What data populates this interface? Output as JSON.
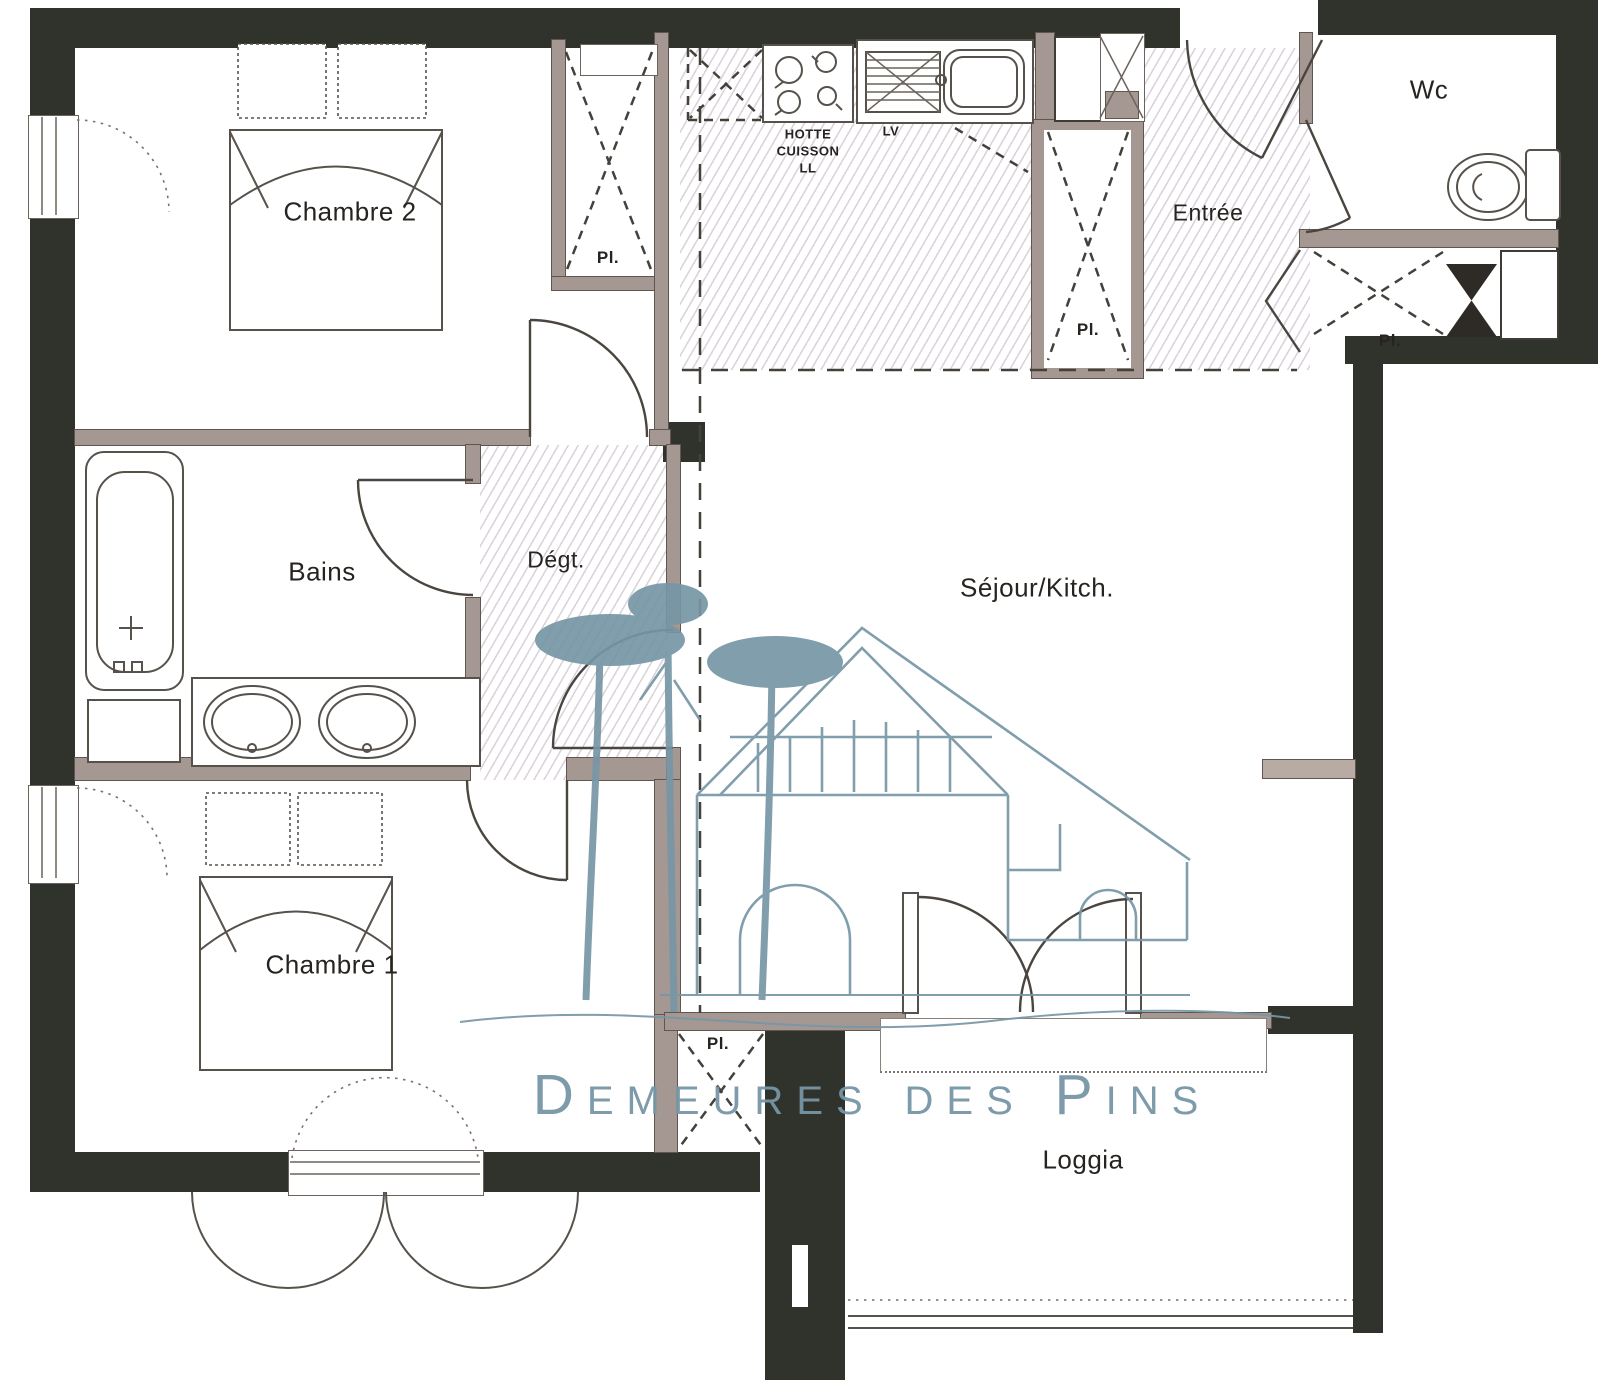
{
  "document": {
    "type": "apartment floor plan"
  },
  "rooms": {
    "chambre2": {
      "label": "Chambre 2"
    },
    "bains": {
      "label": "Bains"
    },
    "degt": {
      "label": "Dégt."
    },
    "chambre1": {
      "label": "Chambre 1"
    },
    "sejour": {
      "label": "Séjour/Kitch."
    },
    "entree": {
      "label": "Entrée"
    },
    "wc": {
      "label": "Wc"
    },
    "loggia": {
      "label": "Loggia"
    }
  },
  "closets": {
    "chambre2": "Pl.",
    "kitchen": "Pl.",
    "wc": "Pl.",
    "chambre1": "Pl."
  },
  "kitchen": {
    "hood_lines": [
      "HOTTE",
      "CUISSON",
      "LL"
    ],
    "dishwasher_label": "LV"
  },
  "watermark": {
    "text": "Demeures des Pins"
  },
  "colors": {
    "paper": "#ffffff",
    "exterior_wall": "#30322c",
    "interior_wall": "#a59791",
    "line": "#57514b",
    "watermark": "#7796a6",
    "label": "#272420"
  }
}
